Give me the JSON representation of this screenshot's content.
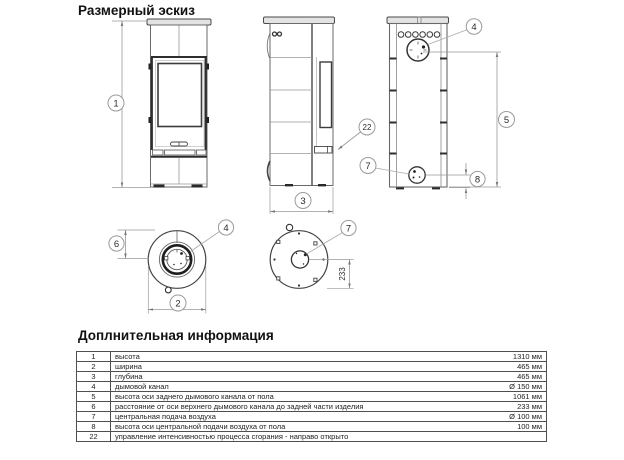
{
  "page": {
    "title": "Размерный эскиз",
    "info_title": "Доплнительная информация"
  },
  "drawing": {
    "callouts": {
      "height": "1",
      "width": "2",
      "depth": "3",
      "flue_back": "4",
      "flue_top": "4",
      "flue_axis_height": "5",
      "flue_to_back": "6",
      "air_back": "7",
      "air_bottom": "7",
      "air_height": "8",
      "control": "22"
    },
    "dim_233": "233"
  },
  "table": {
    "rows": [
      {
        "num": "1",
        "desc": "высота",
        "value": "1310 мм"
      },
      {
        "num": "2",
        "desc": "ширина",
        "value": "465 мм"
      },
      {
        "num": "3",
        "desc": "глубина",
        "value": "465 мм"
      },
      {
        "num": "4",
        "desc": "дымовой канал",
        "value": "Ø 150 мм"
      },
      {
        "num": "5",
        "desc": "высота оси заднего дымового канала от пола",
        "value": "1061 мм"
      },
      {
        "num": "6",
        "desc": "расстояние от оси верхнего дымового канала до задней части изделия",
        "value": "233 мм"
      },
      {
        "num": "7",
        "desc": "центральная подача воздуха",
        "value": "Ø 100 мм"
      },
      {
        "num": "8",
        "desc": "высота оси центральной подачи воздуха от пола",
        "value": "100 мм"
      },
      {
        "num": "22",
        "desc": "управление интенсивностью процесса сгорания - направо открыто",
        "value": ""
      }
    ]
  }
}
